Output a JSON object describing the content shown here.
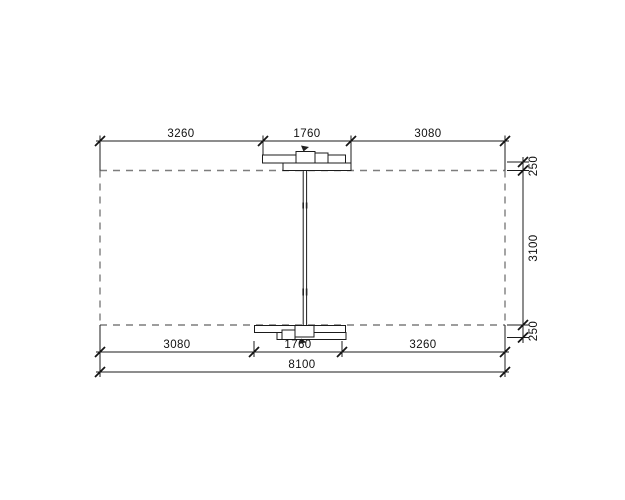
{
  "drawing": {
    "type": "structural-beam-dimension-drawing",
    "colors": {
      "background": "#ffffff",
      "line": "#1b1b1b",
      "dashed_line": "#7d7d7d",
      "text": "#101010"
    },
    "dimensions": {
      "top_row": [
        {
          "label": "3260",
          "value": 3260
        },
        {
          "label": "1760",
          "value": 1760
        },
        {
          "label": "3080",
          "value": 3080
        }
      ],
      "bottom_row": [
        {
          "label": "3080",
          "value": 3080
        },
        {
          "label": "1760",
          "value": 1760
        },
        {
          "label": "3260",
          "value": 3260
        }
      ],
      "total_width": {
        "label": "8100",
        "value": 8100
      },
      "right_column": [
        {
          "label": "250",
          "value": 250
        },
        {
          "label": "3100",
          "value": 3100
        },
        {
          "label": "250",
          "value": 250
        }
      ]
    }
  }
}
